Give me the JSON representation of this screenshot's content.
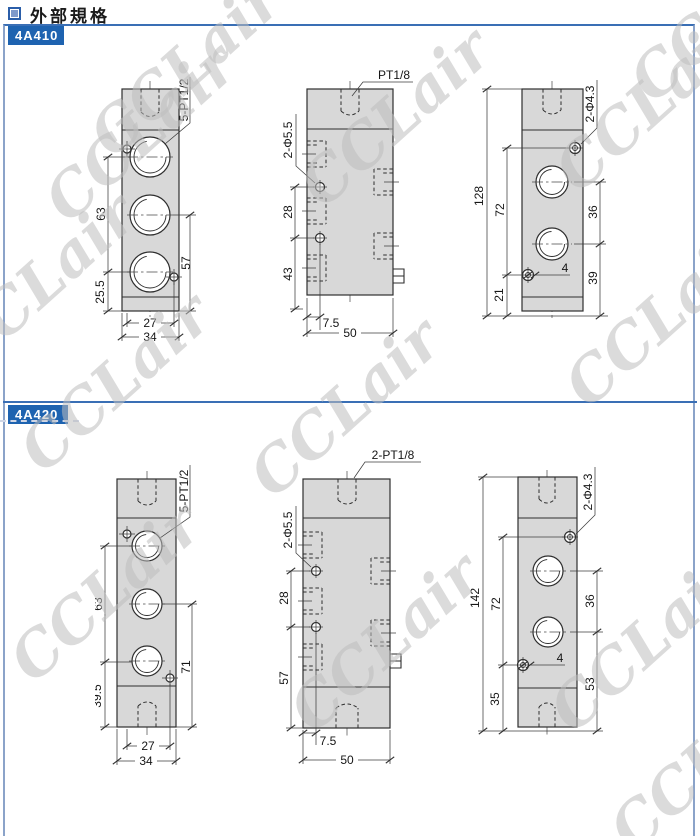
{
  "page": {
    "title": "外部規格",
    "watermark": "CCLair"
  },
  "sections": [
    {
      "model": "4A410",
      "front": {
        "thread_label": "5-PT1/2",
        "dim_left_top": "63",
        "dim_left_bottom": "25.5",
        "dim_right": "57",
        "dim_bottom_inner": "27",
        "dim_bottom_outer": "34"
      },
      "side": {
        "thread_label": "PT1/8",
        "hole_label": "2-Φ5.5",
        "dim_left_top": "28",
        "dim_left_bottom": "43",
        "dim_bottom_inner": "7.5",
        "dim_bottom_outer": "50"
      },
      "back": {
        "hole_label": "2-Φ4.3",
        "dim_total": "128",
        "dim_mid": "72",
        "dim_bottom_left": "21",
        "dim_right_top": "36",
        "dim_right_bottom": "39",
        "dim_offset": "4"
      }
    },
    {
      "model": "4A420",
      "front": {
        "thread_label": "5-PT1/2",
        "dim_left_top": "63",
        "dim_left_bottom": "39.5",
        "dim_right": "71",
        "dim_bottom_inner": "27",
        "dim_bottom_outer": "34"
      },
      "side": {
        "thread_label": "2-PT1/8",
        "hole_label": "2-Φ5.5",
        "dim_left_top": "28",
        "dim_left_bottom": "57",
        "dim_bottom_inner": "7.5",
        "dim_bottom_outer": "50"
      },
      "back": {
        "hole_label": "2-Φ4.3",
        "dim_total": "142",
        "dim_mid": "72",
        "dim_bottom_left": "35",
        "dim_right_top": "36",
        "dim_right_bottom": "53",
        "dim_offset": "4"
      }
    }
  ]
}
